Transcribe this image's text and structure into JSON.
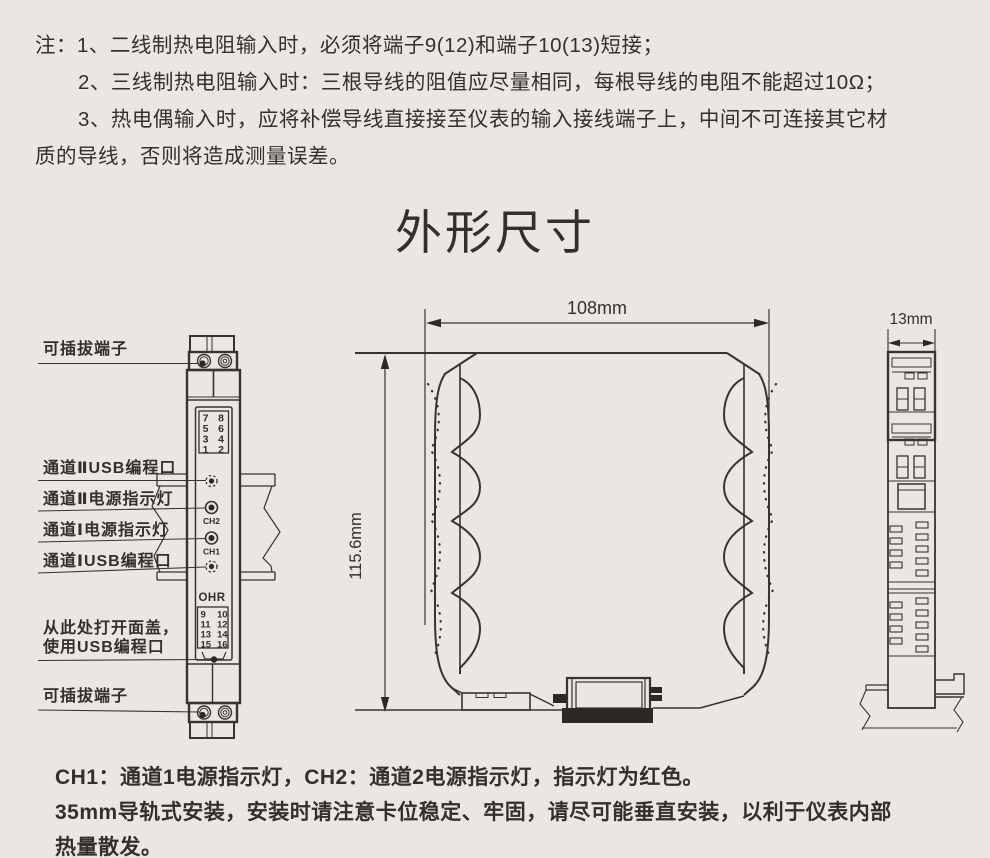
{
  "page": {
    "background_color": "#e9e6e3",
    "ink_color": "#362e29"
  },
  "notes": {
    "line1": "注：1、二线制热电阻输入时，必须将端子9(12)和端子10(13)短接；",
    "line2": "2、三线制热电阻输入时：三根导线的阻值应尽量相同，每根导线的电阻不能超过10Ω；",
    "line3": "3、热电偶输入时，应将补偿导线直接接至仪表的输入接线端子上，中间不可连接其它材",
    "line4": "质的导线，否则将造成测量误差。"
  },
  "title": "外形尺寸",
  "front_view": {
    "labels": {
      "pluggable_terminal_top": "可插拔端子",
      "ch2_usb_port": "通道ⅡUSB编程口",
      "ch2_power_led": "通道Ⅱ电源指示灯",
      "ch1_power_led": "通道Ⅰ电源指示灯",
      "ch1_usb_port": "通道ⅠUSB编程口",
      "open_cover_line1": "从此处打开面盖，",
      "open_cover_line2": "使用USB编程口",
      "pluggable_terminal_bottom": "可插拔端子"
    },
    "terminals_top": [
      [
        "7",
        "8"
      ],
      [
        "5",
        "6"
      ],
      [
        "3",
        "4"
      ],
      [
        "1",
        "2"
      ]
    ],
    "terminals_bottom": [
      [
        "9",
        "10"
      ],
      [
        "11",
        "12"
      ],
      [
        "13",
        "14"
      ],
      [
        "15",
        "16"
      ]
    ],
    "led_ch2_label": "CH2",
    "led_ch1_label": "CH1",
    "brand_logo": "OHR"
  },
  "profile_view": {
    "width_dim": "108mm",
    "height_dim": "115.6mm"
  },
  "side_view": {
    "width_dim": "13mm"
  },
  "footer": {
    "line1": "CH1：通道1电源指示灯，CH2：通道2电源指示灯，指示灯为红色。",
    "line2": "35mm导轨式安装，安装时请注意卡位稳定、牢固，请尽可能垂直安装，以利于仪表内部",
    "line3": "热量散发。"
  }
}
